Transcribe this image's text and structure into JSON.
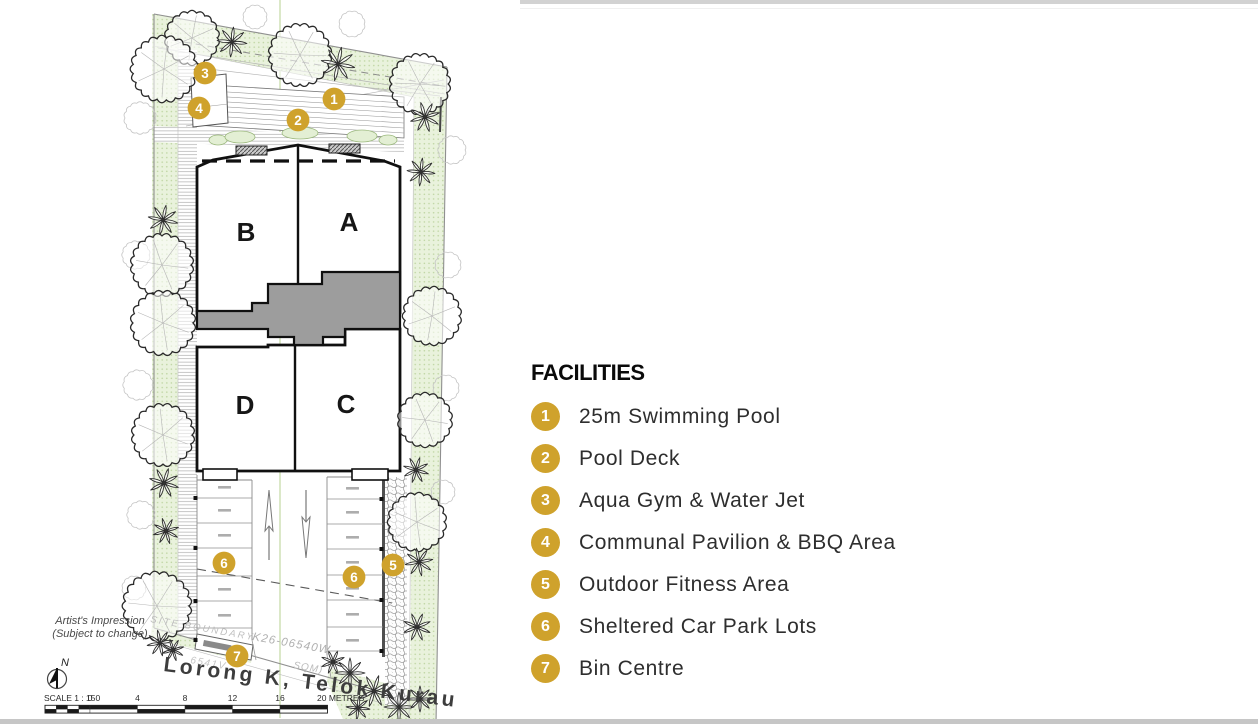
{
  "legend": {
    "title": "FACILITIES",
    "marker_color": "#CFA22C",
    "items": [
      {
        "num": "1",
        "label": "25m Swimming Pool"
      },
      {
        "num": "2",
        "label": "Pool Deck"
      },
      {
        "num": "3",
        "label": "Aqua Gym & Water Jet"
      },
      {
        "num": "4",
        "label": "Communal Pavilion & BBQ Area"
      },
      {
        "num": "5",
        "label": "Outdoor Fitness Area"
      },
      {
        "num": "6",
        "label": "Sheltered Car Park Lots"
      },
      {
        "num": "7",
        "label": "Bin Centre"
      }
    ]
  },
  "plan": {
    "blocks": [
      {
        "label": "A",
        "x": 349,
        "y": 231
      },
      {
        "label": "B",
        "x": 246,
        "y": 241
      },
      {
        "label": "C",
        "x": 346,
        "y": 413
      },
      {
        "label": "D",
        "x": 245,
        "y": 414
      }
    ],
    "markers": [
      {
        "num": "1",
        "x": 334,
        "y": 99
      },
      {
        "num": "2",
        "x": 298,
        "y": 120
      },
      {
        "num": "3",
        "x": 205,
        "y": 73
      },
      {
        "num": "4",
        "x": 199,
        "y": 108
      },
      {
        "num": "5",
        "x": 393,
        "y": 565
      },
      {
        "num": "6",
        "x": 224,
        "y": 563
      },
      {
        "num": "6",
        "x": 354,
        "y": 577
      },
      {
        "num": "7",
        "x": 237,
        "y": 656
      }
    ],
    "road_name": "Lorong K, Telok Kurau",
    "north_label": "N",
    "notes": [
      "Artist's Impression",
      "(Subject to change)"
    ],
    "scale": {
      "label": "SCALE 1 : 150",
      "ticks": [
        "0",
        "4",
        "8",
        "12",
        "16"
      ],
      "end_label": "20 METRES"
    },
    "survey_texts": [
      {
        "text": "SITE BOUNDARY",
        "x": 150,
        "y": 622,
        "rot": 10,
        "size": 9.5,
        "ls": 2.2,
        "color": "#bdbdbd"
      },
      {
        "text": "K26-06540W",
        "x": 252,
        "y": 640,
        "rot": 10,
        "size": 11.5,
        "ls": 1.2,
        "color": "#b0b0b0"
      },
      {
        "text": "6541V",
        "x": 190,
        "y": 663,
        "rot": 10,
        "size": 10,
        "ls": 1.5,
        "color": "#c4c4c4"
      },
      {
        "text": "SQM)",
        "x": 293,
        "y": 668,
        "rot": 10,
        "size": 10,
        "ls": 1,
        "color": "#bbbbbb"
      }
    ]
  }
}
